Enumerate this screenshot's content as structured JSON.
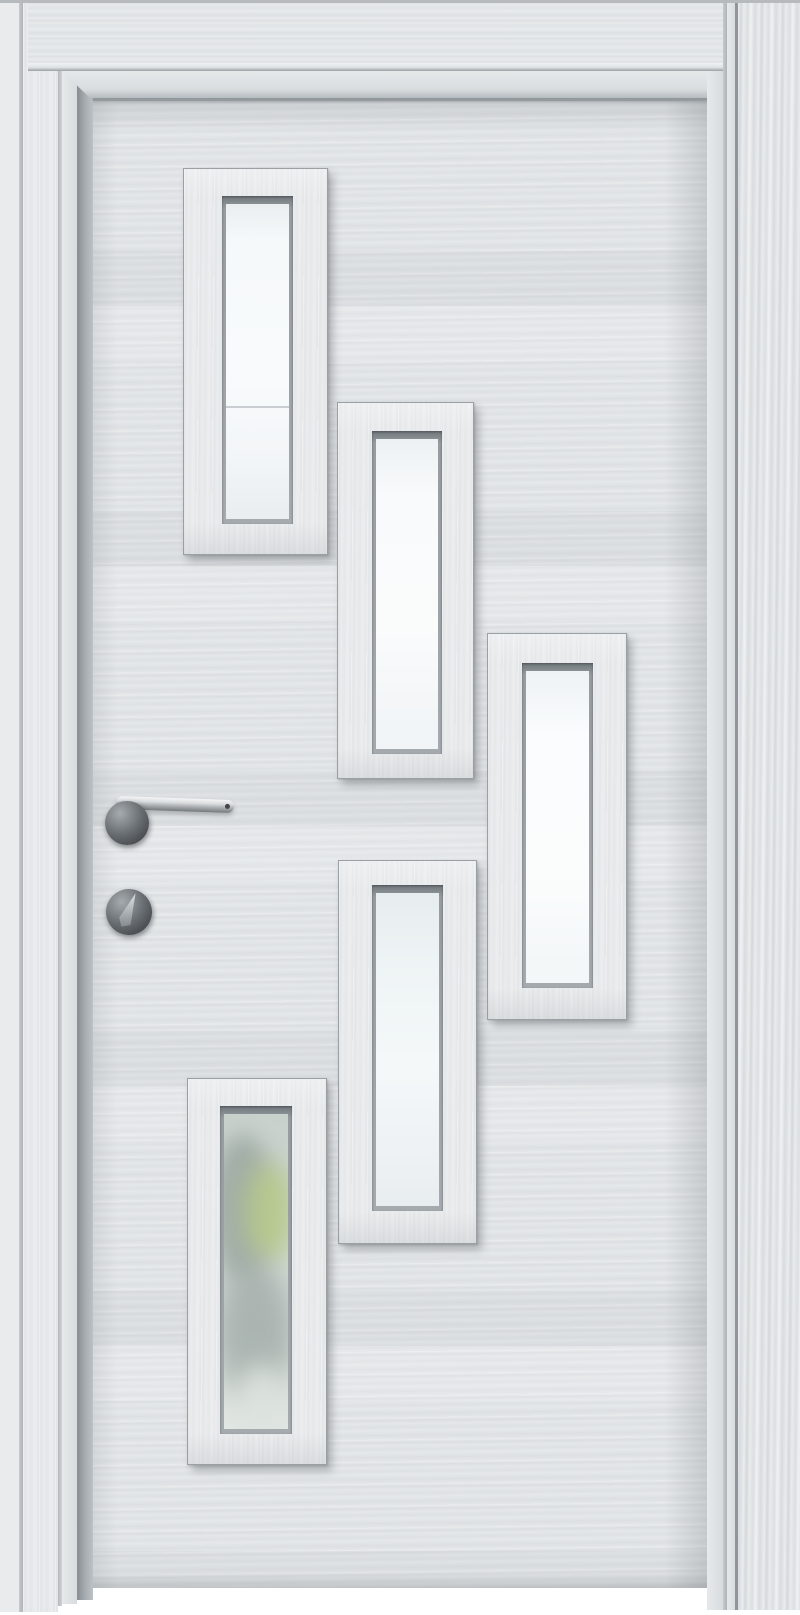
{
  "scene": {
    "type": "product-photo",
    "subject": "White-grey laminate interior door with five staggered rectangular frosted-glass panels, lever handle and thumb-turn lock, shown inside a matching door frame",
    "background_color": "#ffffff",
    "canvas": {
      "w": 800,
      "h": 1615
    }
  },
  "palette": {
    "background": "#ffffff",
    "door_leaf": "#e0e3e5",
    "panel_frame": "#e6e8e9",
    "casing": "#e7e9ea",
    "grain_dark": "#d4d8db",
    "grain_light": "#f0f1f2",
    "gap_shadow": "#878d91",
    "bead_dark": "#70777c",
    "glass_white": "#f6f9fa",
    "glass_line": "#c8ced1",
    "hardware_dark": "#43474b",
    "hardware_mid": "#7d8286",
    "hardware_light": "#e2e5e7",
    "foliage_green": "#b9cd86"
  },
  "structure": {
    "top_edge_line": {
      "x": 0,
      "y": 0,
      "w": 800,
      "h": 3
    },
    "left_wall": {
      "x": 0,
      "y": 0,
      "w": 19,
      "h": 1612
    },
    "left_wall_groove": {
      "x": 19,
      "y": 0,
      "w": 4,
      "h": 1612
    },
    "left_casing": {
      "x": 23,
      "y": 0,
      "w": 35,
      "h": 1612
    },
    "left_casing_line": {
      "x": 58,
      "y": 0,
      "w": 4,
      "h": 1606
    },
    "left_jamb": {
      "x": 62,
      "y": 0,
      "w": 15,
      "h": 1604
    },
    "left_gap": {
      "x": 77,
      "y": 63,
      "w": 16,
      "h": 1537
    },
    "top_architrave": {
      "x": 28,
      "y": 0,
      "w": 706,
      "h": 63
    },
    "top_groove": {
      "x": 28,
      "y": 63,
      "w": 706,
      "h": 8
    },
    "head_jamb": {
      "x": 62,
      "y": 71,
      "w": 660,
      "h": 30
    },
    "head_shadow": {
      "x": 93,
      "y": 98,
      "w": 614,
      "h": 6
    },
    "door_leaf": {
      "x": 93,
      "y": 101,
      "w": 614,
      "h": 1487
    },
    "right_jamb": {
      "x": 707,
      "y": 71,
      "w": 16,
      "h": 1539
    },
    "right_jamb_groove": {
      "x": 723,
      "y": 0,
      "w": 4,
      "h": 1610
    },
    "right_jamb_face": {
      "x": 727,
      "y": 0,
      "w": 8,
      "h": 1610
    },
    "right_casing_line": {
      "x": 735,
      "y": 0,
      "w": 3,
      "h": 1610
    },
    "right_casing": {
      "x": 738,
      "y": 0,
      "w": 62,
      "h": 1610
    }
  },
  "panels": [
    {
      "id": "panel-1-top-left",
      "x": 183,
      "y": 168,
      "w": 143,
      "h": 385,
      "bead": {
        "x": 38,
        "y": 27,
        "w": 71,
        "h": 328
      },
      "glass": {
        "type": "line",
        "bg": "linear-gradient(180deg,#e9eef0,#f6f9fa 12%,#f8fafb 55%,#f3f6f8 80%,#e9edef)",
        "line_pos_pct": 64
      }
    },
    {
      "id": "panel-2-upper-middle",
      "x": 337,
      "y": 402,
      "w": 135,
      "h": 375,
      "bead": {
        "x": 34,
        "y": 28,
        "w": 70,
        "h": 323
      },
      "glass": {
        "type": "plain",
        "bg": "linear-gradient(180deg,#edf1f3,#f8fafb 18%,#fafcfc 60%,#f2f5f7 92%)"
      }
    },
    {
      "id": "panel-3-right",
      "x": 487,
      "y": 633,
      "w": 138,
      "h": 385,
      "bead": {
        "x": 34,
        "y": 29,
        "w": 71,
        "h": 325
      },
      "glass": {
        "type": "plain",
        "bg": "linear-gradient(180deg,#eef2f4,#fafcfd 20%,#fbfdfd 65%,#f4f7f8 93%)"
      }
    },
    {
      "id": "panel-4-lower-middle",
      "x": 338,
      "y": 860,
      "w": 137,
      "h": 382,
      "bead": {
        "x": 33,
        "y": 24,
        "w": 71,
        "h": 326
      },
      "glass": {
        "type": "plain",
        "bg": "linear-gradient(180deg,#e7edef,#eff4f5 25%,#f4f8f9 55%,#edf1f3 85%,#e8edef)"
      }
    },
    {
      "id": "panel-5-bottom-left",
      "x": 187,
      "y": 1078,
      "w": 138,
      "h": 385,
      "bead": {
        "x": 32,
        "y": 27,
        "w": 72,
        "h": 328
      },
      "glass": {
        "type": "blobs",
        "bg": "linear-gradient(180deg,#c9d1cd,#ccd4d0 30%,#d6dcd9 65%,#e2e7e4)",
        "blobs": [
          {
            "l": -14,
            "t": 20,
            "w": 66,
            "h": 150,
            "c": "#9aa7a1",
            "blur": 11,
            "op": 0.85
          },
          {
            "l": 20,
            "t": 48,
            "w": 52,
            "h": 100,
            "c": "#b9cd86",
            "blur": 13,
            "op": 0.8
          },
          {
            "l": -8,
            "t": 150,
            "w": 78,
            "h": 140,
            "c": "#a4aeaa",
            "blur": 13,
            "op": 0.85
          },
          {
            "l": 8,
            "t": 250,
            "w": 60,
            "h": 90,
            "c": "#dde3df",
            "blur": 12,
            "op": 0.9
          }
        ]
      }
    }
  ],
  "hardware": {
    "rose": {
      "x": 105,
      "y": 801,
      "w": 44,
      "h": 44
    },
    "lever": {
      "x": 116,
      "y": 796,
      "w": 118,
      "h": 13
    },
    "thumb_rose": {
      "x": 106,
      "y": 889,
      "w": 46,
      "h": 46
    },
    "thumb_knob": {
      "x": 122,
      "y": 892,
      "w": 13,
      "h": 36
    }
  }
}
